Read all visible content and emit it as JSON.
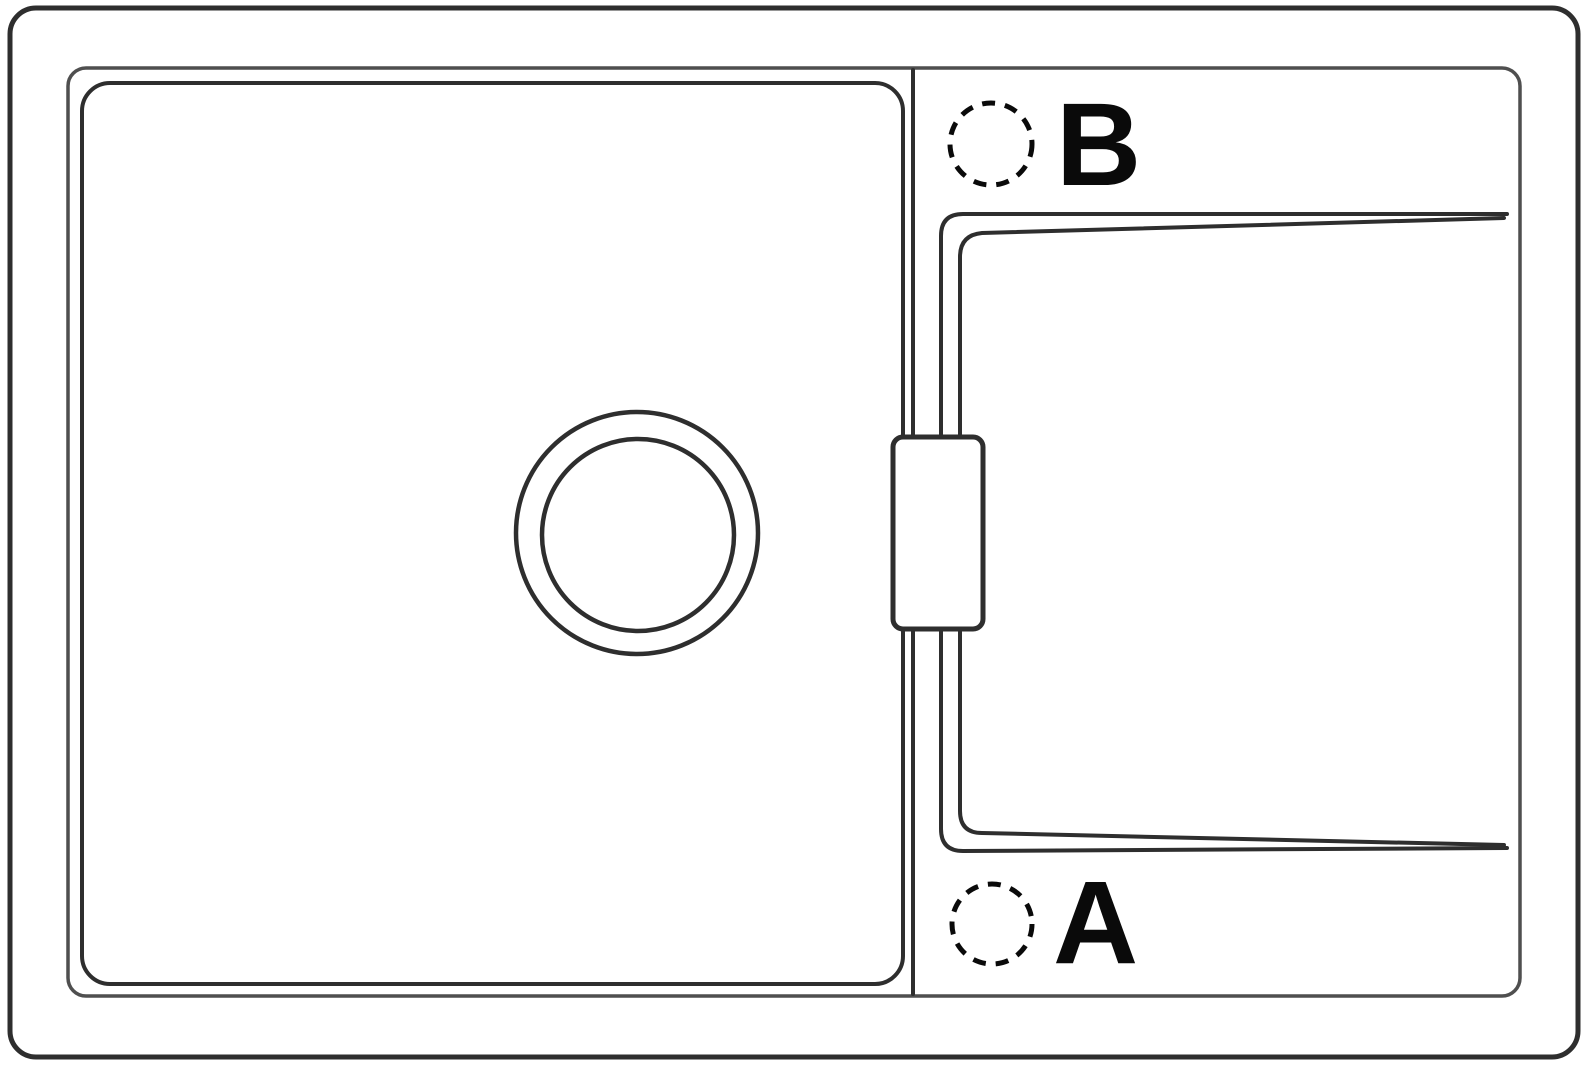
{
  "labels": {
    "hole_b": "B",
    "hole_a": "A"
  },
  "colors": {
    "background": "#ffffff",
    "outline": "#2e2e2e",
    "outline_light": "#4f4f4f",
    "label": "#0a0a0a"
  }
}
